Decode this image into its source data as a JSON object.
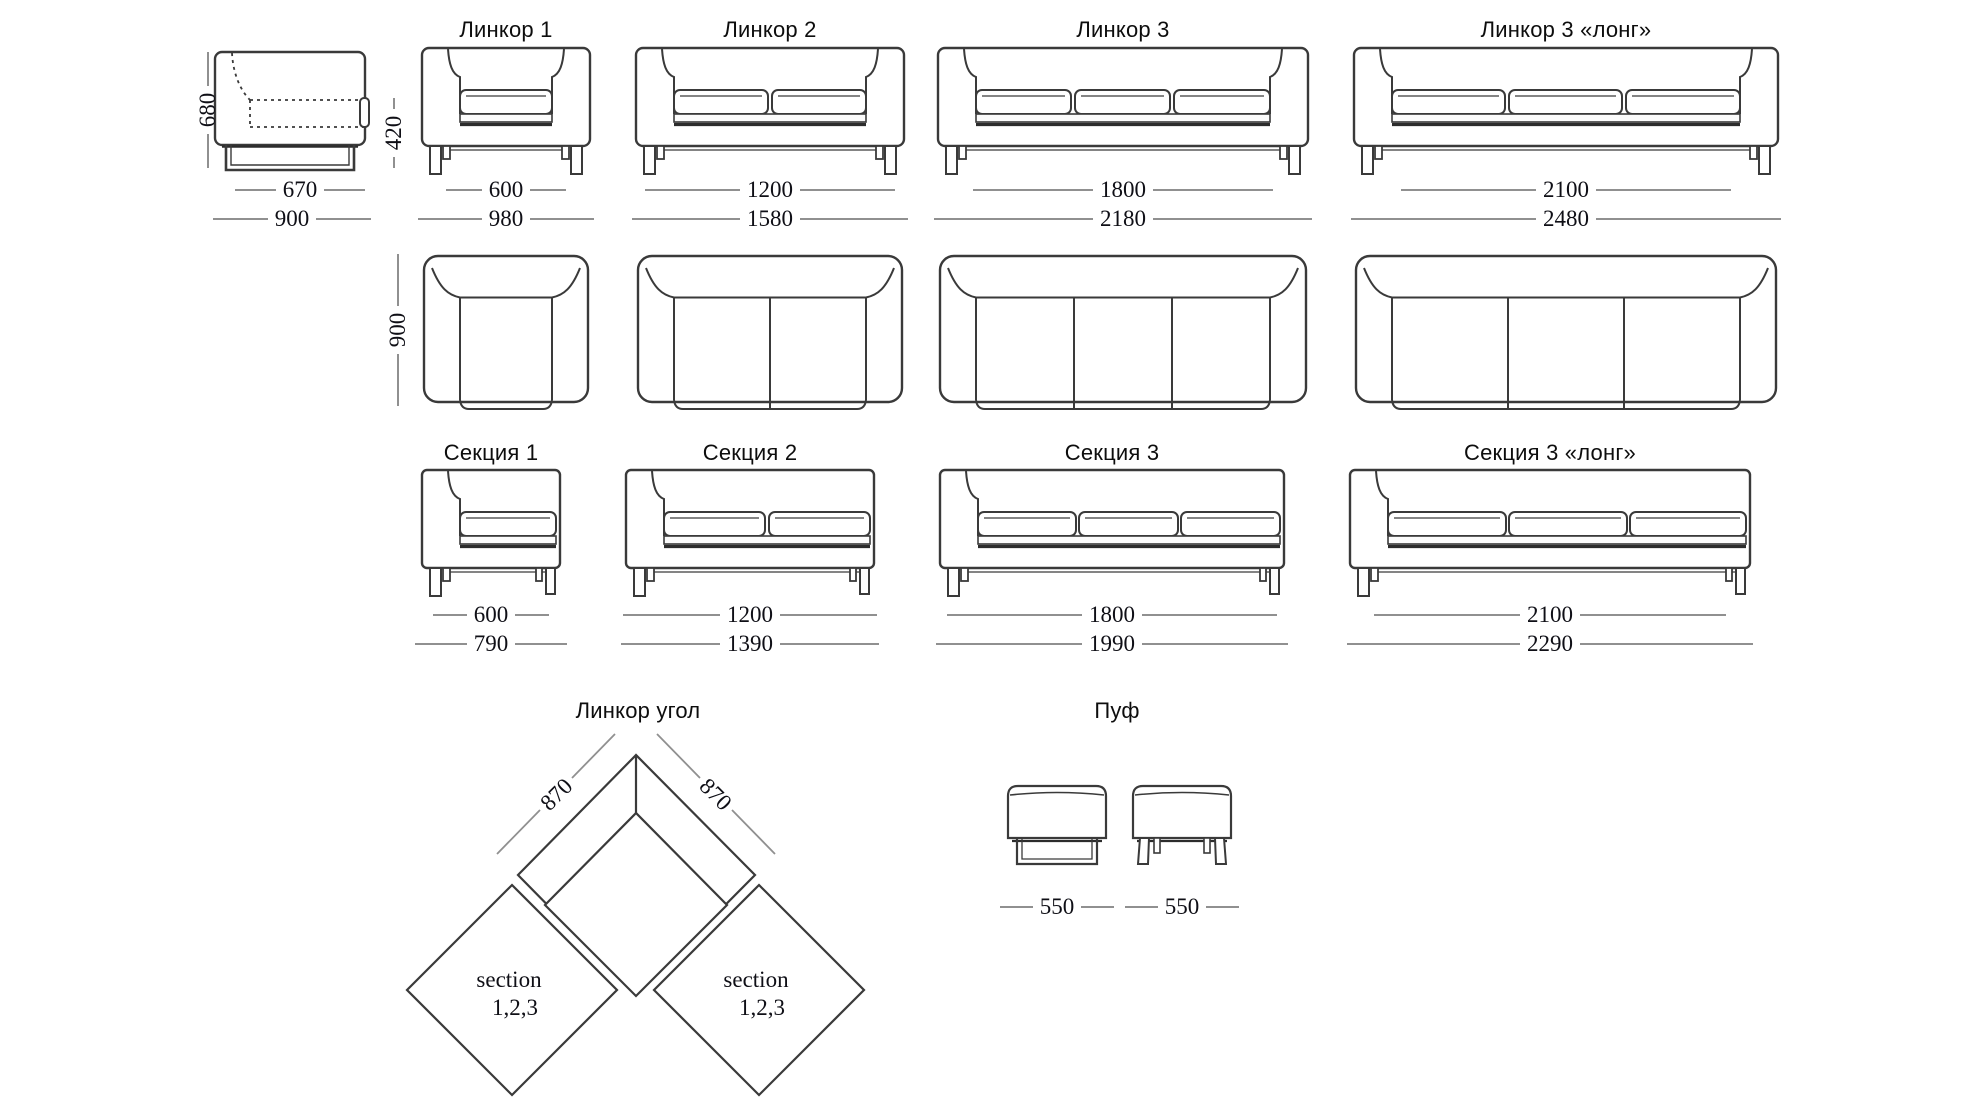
{
  "page": {
    "background": "#ffffff",
    "line_color": "#3a3a3a",
    "dim_line_color": "#909090"
  },
  "side_view": {
    "height": "680",
    "seat_height": "420",
    "depth": "670",
    "full_depth": "900"
  },
  "top_row_depth": "900",
  "sofas": [
    {
      "name": "Линкор 1",
      "seats": 1,
      "width": "600",
      "full_width": "980"
    },
    {
      "name": "Линкор 2",
      "seats": 2,
      "width": "1200",
      "full_width": "1580"
    },
    {
      "name": "Линкор 3",
      "seats": 3,
      "width": "1800",
      "full_width": "2180"
    },
    {
      "name": "Линкор 3 «лонг»",
      "seats": 3,
      "width": "2100",
      "full_width": "2480"
    }
  ],
  "sections": [
    {
      "name": "Секция 1",
      "seats": 1,
      "width": "600",
      "full_width": "790"
    },
    {
      "name": "Секция 2",
      "seats": 2,
      "width": "1200",
      "full_width": "1390"
    },
    {
      "name": "Секция 3",
      "seats": 3,
      "width": "1800",
      "full_width": "1990"
    },
    {
      "name": "Секция 3 «лонг»",
      "seats": 3,
      "width": "2100",
      "full_width": "2290"
    }
  ],
  "corner": {
    "title": "Линкор угол",
    "dim_left": "870",
    "dim_right": "870",
    "section_word": "section",
    "section_numbers": "1,2,3"
  },
  "pouf": {
    "title": "Пуф",
    "dim_left": "550",
    "dim_right": "550"
  }
}
